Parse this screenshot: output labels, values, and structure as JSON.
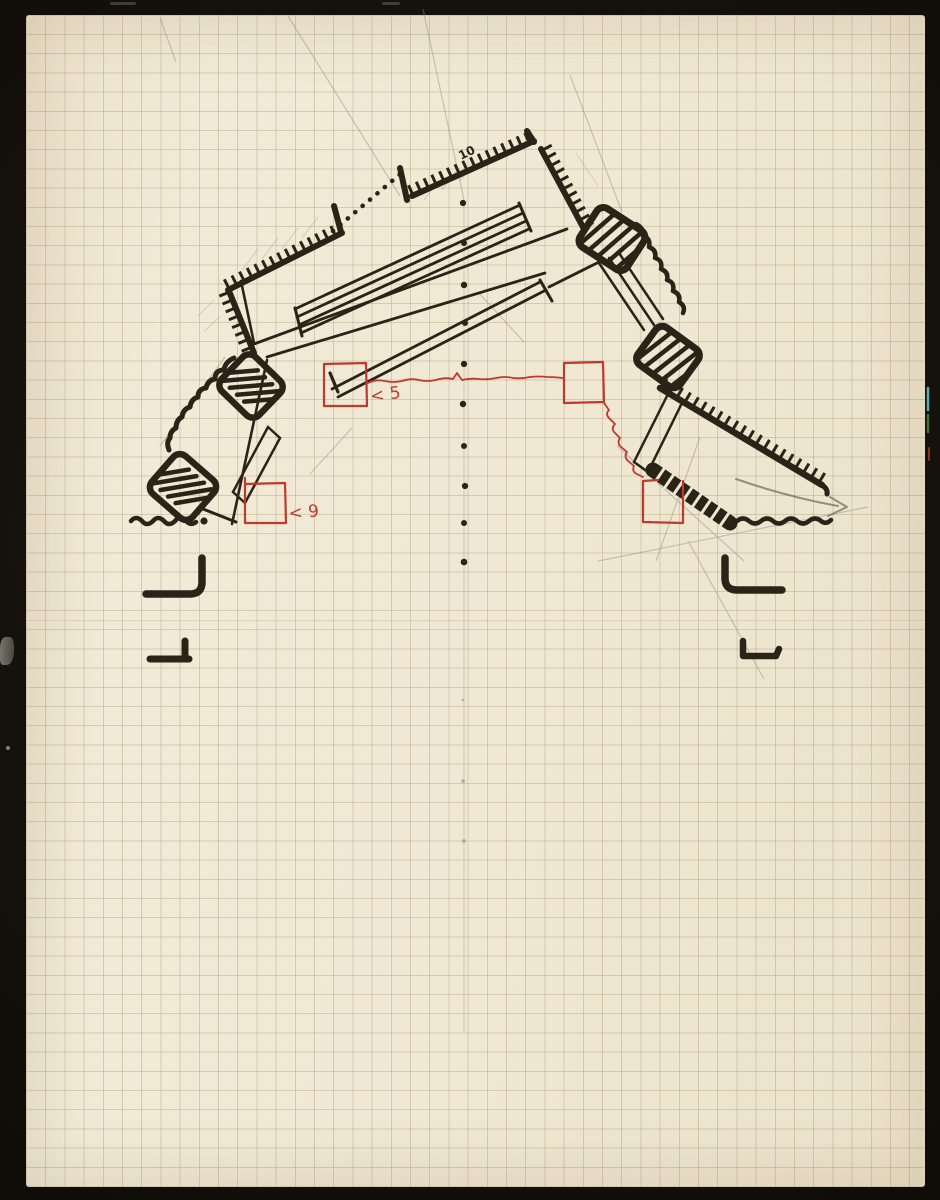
{
  "artwork": {
    "annotations": {
      "top_number": "10",
      "square5_label": "< 5",
      "square9_label": "< 9"
    },
    "colors": {
      "paper": "#efe7d1",
      "grid_line": "#b49a6a",
      "black_ink": "#2a2318",
      "red_ink": "#bf3a2c",
      "pencil": "#948c7c",
      "scan_background": "#14110c"
    }
  }
}
